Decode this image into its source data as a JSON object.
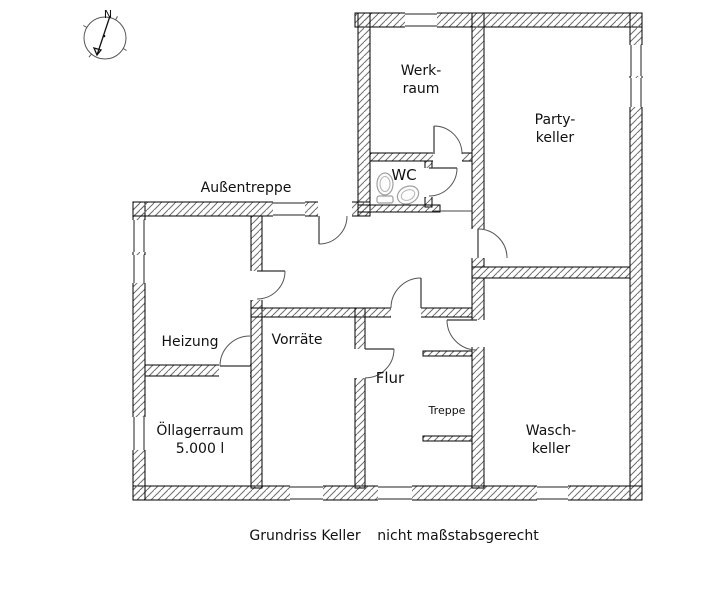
{
  "caption": {
    "left": "Grundriss Keller",
    "right": "nicht maßstabsgerecht"
  },
  "compass": {
    "north_label": "N",
    "cx": 105,
    "cy": 38,
    "r": 21
  },
  "colors": {
    "wall_hatch": "#6f6f6f",
    "line": "#000000",
    "text": "#111111"
  },
  "labels": [
    {
      "id": "aussentreppe",
      "lines": [
        "Außentreppe"
      ],
      "cx": 246,
      "cy": 188,
      "size": 14
    },
    {
      "id": "werkraum",
      "lines": [
        "Werk-",
        "raum"
      ],
      "cx": 421,
      "cy": 80,
      "size": 14
    },
    {
      "id": "partykeller",
      "lines": [
        "Party-",
        "keller"
      ],
      "cx": 555,
      "cy": 129,
      "size": 14
    },
    {
      "id": "wc",
      "lines": [
        "WC"
      ],
      "cx": 404,
      "cy": 175,
      "size": 15
    },
    {
      "id": "heizung",
      "lines": [
        "Heizung"
      ],
      "cx": 190,
      "cy": 342,
      "size": 14
    },
    {
      "id": "vorraete",
      "lines": [
        "Vorräte"
      ],
      "cx": 297,
      "cy": 340,
      "size": 14
    },
    {
      "id": "flur",
      "lines": [
        "Flur"
      ],
      "cx": 390,
      "cy": 378,
      "size": 15
    },
    {
      "id": "treppe",
      "lines": [
        "Treppe"
      ],
      "cx": 447,
      "cy": 411,
      "size": 11
    },
    {
      "id": "oellagerraum",
      "lines": [
        "Öllagerraum",
        "5.000 l"
      ],
      "cx": 200,
      "cy": 440,
      "size": 14
    },
    {
      "id": "waschkeller",
      "lines": [
        "Wasch-",
        "keller"
      ],
      "cx": 551,
      "cy": 440,
      "size": 14
    }
  ],
  "plan": {
    "walls": [
      [
        355,
        13,
        287,
        14
      ],
      [
        630,
        13,
        12,
        487
      ],
      [
        133,
        486,
        509,
        14
      ],
      [
        133,
        202,
        12,
        298
      ],
      [
        133,
        202,
        237,
        14
      ],
      [
        358,
        13,
        12,
        203
      ],
      [
        370,
        153,
        102,
        8
      ],
      [
        425,
        161,
        7,
        46
      ],
      [
        358,
        205,
        82,
        7
      ],
      [
        251,
        216,
        11,
        272
      ],
      [
        145,
        365,
        106,
        11
      ],
      [
        251,
        308,
        221,
        9
      ],
      [
        355,
        308,
        10,
        180
      ],
      [
        472,
        13,
        12,
        254
      ],
      [
        472,
        267,
        158,
        11
      ],
      [
        472,
        278,
        12,
        210
      ],
      [
        423,
        351,
        49,
        5
      ],
      [
        423,
        436,
        49,
        5
      ]
    ],
    "door_gaps": [
      [
        318,
        202,
        34,
        14
      ],
      [
        433,
        153,
        29,
        8
      ],
      [
        425,
        168,
        7,
        29
      ],
      [
        472,
        229,
        12,
        29
      ],
      [
        251,
        271,
        11,
        29
      ],
      [
        219,
        365,
        31,
        11
      ],
      [
        355,
        349,
        10,
        29
      ],
      [
        391,
        308,
        30,
        9
      ],
      [
        472,
        320,
        12,
        27
      ]
    ],
    "windows": [
      [
        405,
        13,
        32,
        14
      ],
      [
        630,
        45,
        12,
        31
      ],
      [
        630,
        78,
        12,
        29
      ],
      [
        273,
        202,
        32,
        14
      ],
      [
        133,
        220,
        12,
        32
      ],
      [
        133,
        255,
        12,
        28
      ],
      [
        133,
        417,
        12,
        33
      ],
      [
        290,
        486,
        33,
        14
      ],
      [
        378,
        486,
        34,
        14
      ],
      [
        537,
        486,
        31,
        14
      ]
    ],
    "doors": [
      [
        319,
        216,
        28,
        90,
        0
      ],
      [
        434,
        154,
        28,
        270,
        0
      ],
      [
        429,
        168,
        28,
        0,
        90
      ],
      [
        478,
        258,
        29,
        270,
        0
      ],
      [
        257,
        271,
        28,
        0,
        90
      ],
      [
        250,
        366,
        30,
        180,
        270
      ],
      [
        365,
        349,
        29,
        0,
        90
      ],
      [
        421,
        308,
        30,
        270,
        180
      ],
      [
        477,
        320,
        30,
        180,
        90
      ]
    ],
    "lines": [
      [
        432,
        211,
        472,
        211
      ]
    ],
    "fixtures": [
      {
        "type": "toilet",
        "cx": 385,
        "cy": 186
      },
      {
        "type": "sink",
        "cx": 408,
        "cy": 195
      }
    ]
  }
}
